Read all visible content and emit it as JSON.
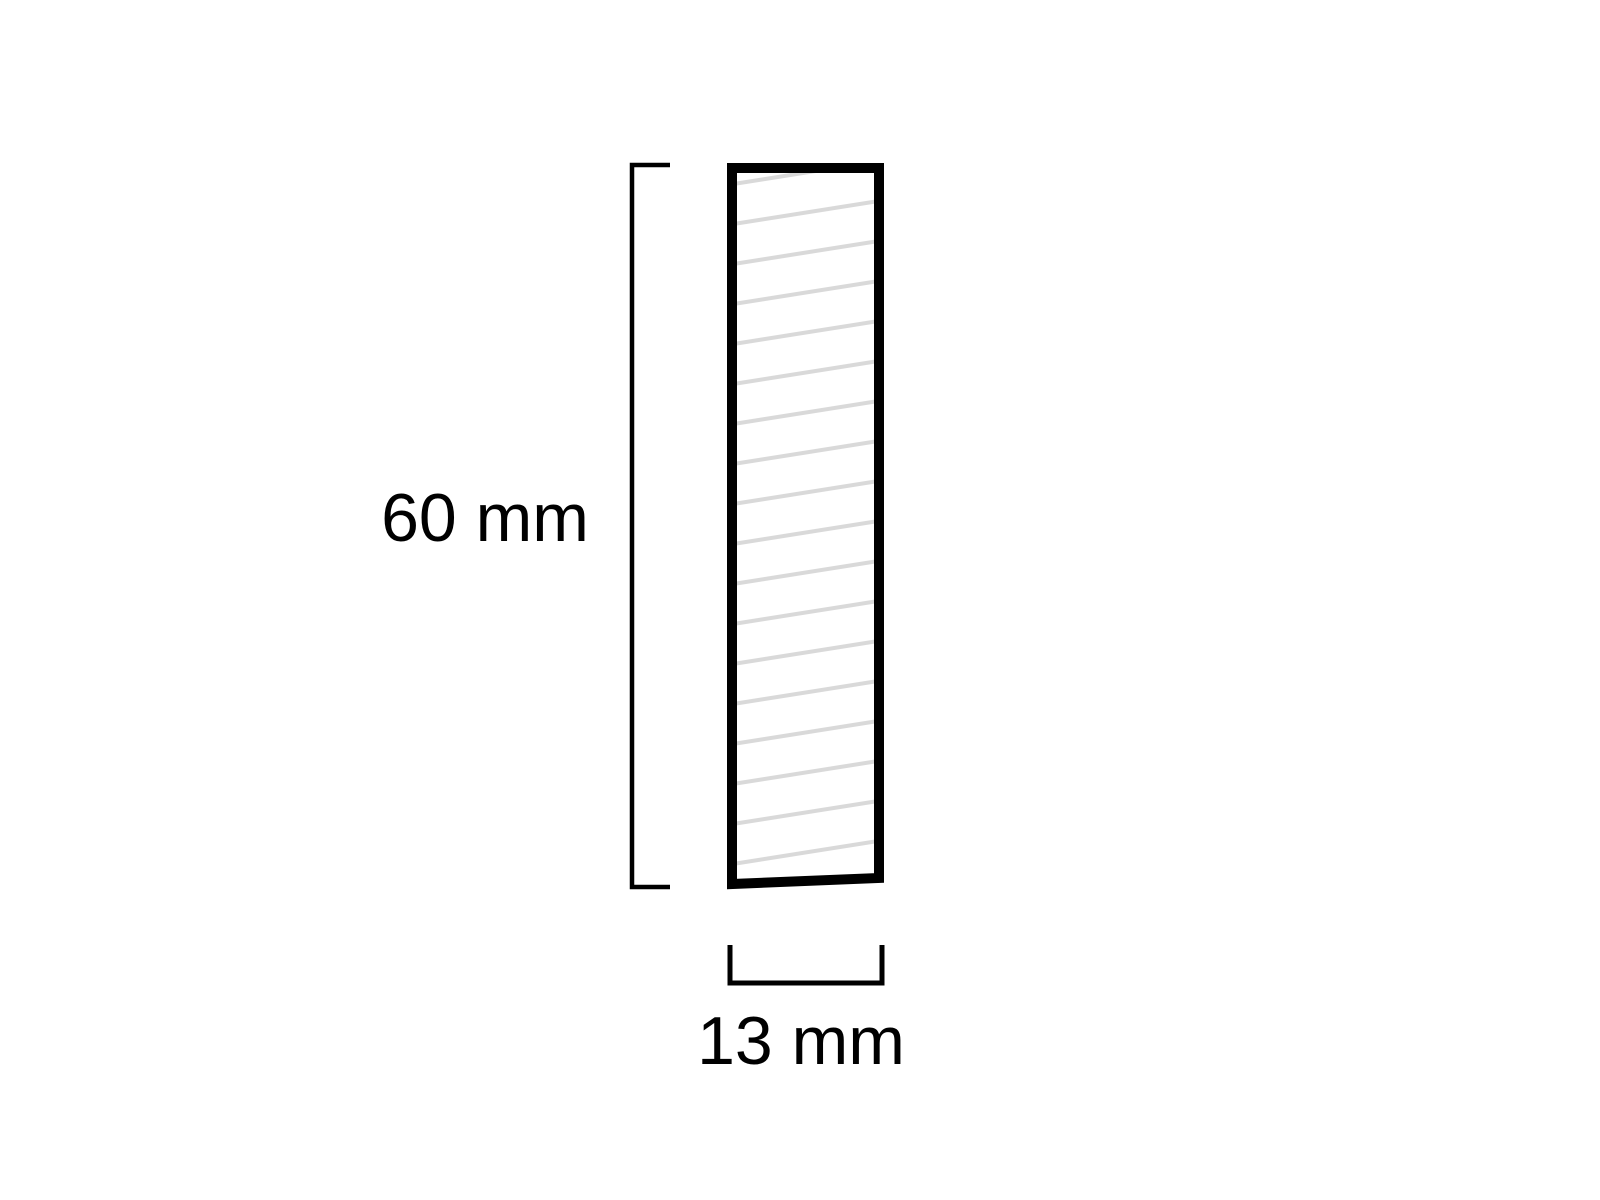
{
  "diagram": {
    "type": "profile-cross-section",
    "height_dimension": {
      "label": "60 mm",
      "value_mm": 60
    },
    "width_dimension": {
      "label": "13 mm",
      "value_mm": 13
    },
    "colors": {
      "background": "#ffffff",
      "outline": "#000000",
      "hatch": "#d9d9d9",
      "dimension_lines": "#000000",
      "label_text": "#000000"
    }
  }
}
